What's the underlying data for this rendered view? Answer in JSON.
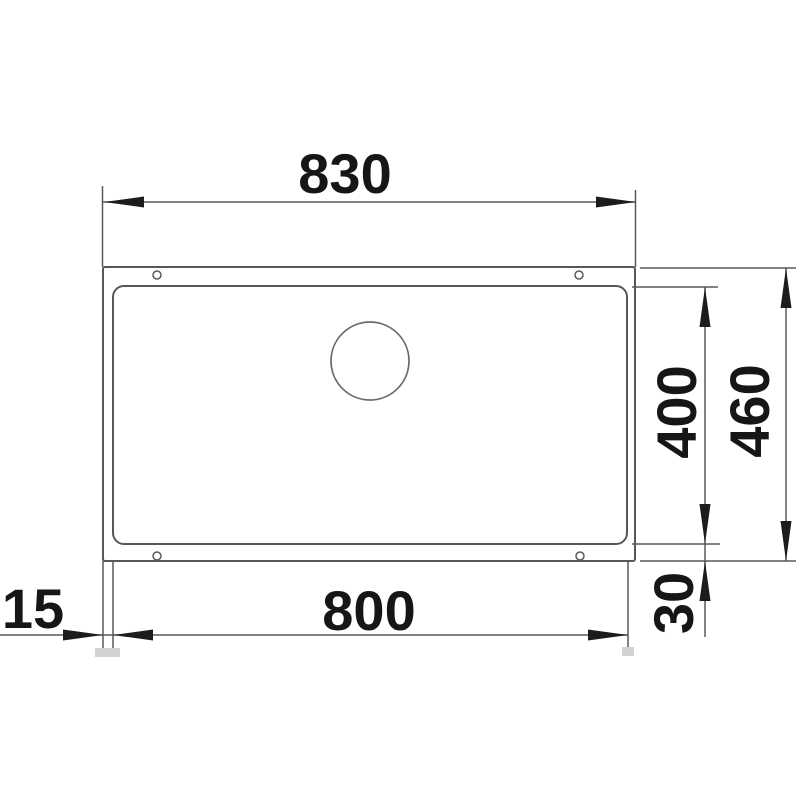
{
  "drawing": {
    "title": "undermount-sink-installation-top-view",
    "labels": {
      "overall_width": "830",
      "bowl_width": "800",
      "bowl_depth": "400",
      "overall_depth": "460",
      "edge_offset_left": "15",
      "edge_offset_bottom": "30"
    },
    "colors": {
      "line": "#575757",
      "arrow_and_text": "#1c1c1c",
      "background": "#ffffff",
      "artifact_square": "#d2d2d2"
    }
  }
}
